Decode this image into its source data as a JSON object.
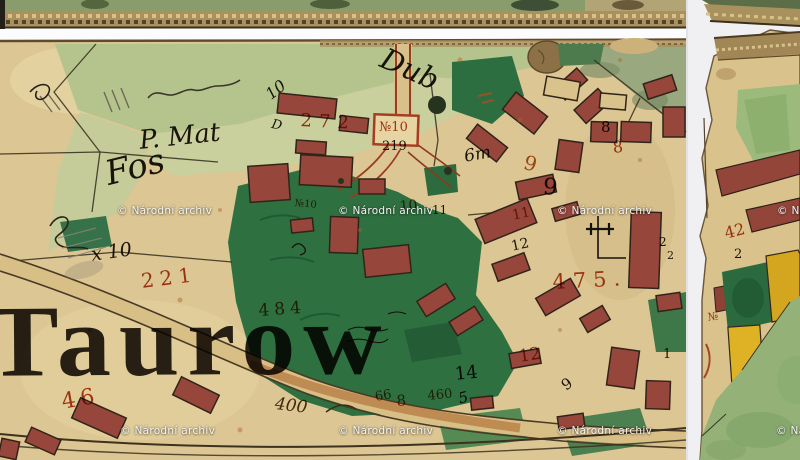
{
  "place_label": {
    "text": "Taurow",
    "color": "#1c150c"
  },
  "watermark": {
    "text": "© Národní archiv",
    "color": "#f4f4f2",
    "positions": [
      {
        "x": 117,
        "y": 205
      },
      {
        "x": 338,
        "y": 205
      },
      {
        "x": 557,
        "y": 205
      },
      {
        "x": 777,
        "y": 205
      },
      {
        "x": 120,
        "y": 425
      },
      {
        "x": 338,
        "y": 425
      },
      {
        "x": 557,
        "y": 425
      },
      {
        "x": 776,
        "y": 425
      }
    ]
  },
  "palette": {
    "paper_tan": "#dcc693",
    "field_green_light": "#b5c48c",
    "field_green_pale": "#c7cf9e",
    "garden_green_dark": "#2e7040",
    "building_maroon": "#96463a",
    "building_yellow": "#d4a51e",
    "red_ink": "#b13f1c",
    "black_ink": "#1f1910",
    "braid_edge": "#a8915c",
    "scan_gap_white": "#fbfbfd",
    "pasture_green": "#94b178"
  },
  "labels": [
    {
      "text": "Dub",
      "x": 388,
      "y": 44,
      "size": 29,
      "rot": 24,
      "script": true,
      "color": "#1f1910"
    },
    {
      "text": "10",
      "x": 263,
      "y": 90,
      "size": 16,
      "rot": -38,
      "script": true,
      "color": "#1f1910"
    },
    {
      "text": "D",
      "x": 273,
      "y": 118,
      "size": 13,
      "rot": 12,
      "script": true,
      "color": "#1f1910"
    },
    {
      "text": "P. Mat",
      "x": 138,
      "y": 128,
      "size": 26,
      "rot": -6,
      "script": true,
      "color": "#1f1910"
    },
    {
      "text": "Fos",
      "x": 102,
      "y": 158,
      "size": 34,
      "rot": -14,
      "script": true,
      "color": "#1f1910"
    },
    {
      "text": "x 10",
      "x": 90,
      "y": 246,
      "size": 19,
      "rot": -8,
      "script": true,
      "color": "#1f1910"
    },
    {
      "text": "219",
      "x": 382,
      "y": 140,
      "size": 13,
      "color": "#1f1910"
    },
    {
      "text": "6m",
      "x": 463,
      "y": 149,
      "size": 17,
      "rot": -10,
      "script": true,
      "color": "#1f1910"
    },
    {
      "text": "8",
      "x": 601,
      "y": 120,
      "size": 15,
      "color": "#1f1910"
    },
    {
      "text": "9",
      "x": 544,
      "y": 176,
      "size": 23,
      "rot": 5,
      "color": "#1f1910"
    },
    {
      "text": "11",
      "x": 432,
      "y": 204,
      "size": 12,
      "color": "#1f1910"
    },
    {
      "text": "12",
      "x": 510,
      "y": 240,
      "size": 14,
      "rot": -12,
      "color": "#1f1910"
    },
    {
      "text": "2",
      "x": 659,
      "y": 236,
      "size": 12,
      "color": "#1f1910"
    },
    {
      "text": "2",
      "x": 667,
      "y": 250,
      "size": 11,
      "color": "#1f1910"
    },
    {
      "text": "2",
      "x": 734,
      "y": 248,
      "size": 13,
      "color": "#1f1910"
    },
    {
      "text": "14",
      "x": 454,
      "y": 366,
      "size": 18,
      "rot": -6,
      "color": "#1f1910"
    },
    {
      "text": "5",
      "x": 457,
      "y": 392,
      "size": 15,
      "rot": -14,
      "script": true,
      "color": "#1f1910"
    },
    {
      "text": "1",
      "x": 663,
      "y": 348,
      "size": 13,
      "color": "#1f1910"
    },
    {
      "text": "9",
      "x": 559,
      "y": 381,
      "size": 15,
      "rot": -35,
      "color": "#1f1910"
    },
    {
      "text": "400",
      "x": 276,
      "y": 396,
      "size": 17,
      "rot": 7,
      "script": true,
      "color": "#4e3416"
    },
    {
      "text": "272",
      "x": 301,
      "y": 112,
      "size": 18,
      "rot": 3,
      "sp": 7,
      "color": "#b13f1c"
    },
    {
      "text": "№10",
      "x": 379,
      "y": 121,
      "size": 13,
      "color": "#b13f1c"
    },
    {
      "text": "9",
      "x": 527,
      "y": 152,
      "size": 20,
      "rot": 16,
      "color": "#b05a1f"
    },
    {
      "text": "8",
      "x": 612,
      "y": 140,
      "size": 16,
      "rot": -6,
      "color": "#b13f1c"
    },
    {
      "text": "10",
      "x": 399,
      "y": 200,
      "size": 14,
      "rot": -5,
      "color": "#b13f1c"
    },
    {
      "text": "11",
      "x": 511,
      "y": 209,
      "size": 14,
      "rot": -12,
      "color": "#b13f1c"
    },
    {
      "text": "№10",
      "x": 295,
      "y": 199,
      "size": 10,
      "rot": 5,
      "color": "#b13f1c"
    },
    {
      "text": "475.",
      "x": 552,
      "y": 272,
      "size": 21,
      "rot": -3,
      "sp": 7,
      "color": "#b3441c"
    },
    {
      "text": "221",
      "x": 140,
      "y": 271,
      "size": 20,
      "rot": -7,
      "sp": 6,
      "color": "#b13f1c"
    },
    {
      "text": "484",
      "x": 258,
      "y": 303,
      "size": 17,
      "rot": -4,
      "sp": 5,
      "color": "#a84420"
    },
    {
      "text": "12",
      "x": 518,
      "y": 349,
      "size": 17,
      "rot": -9,
      "color": "#b13f1c"
    },
    {
      "text": "66",
      "x": 374,
      "y": 391,
      "size": 13,
      "rot": -10,
      "color": "#8d4a1c"
    },
    {
      "text": "8",
      "x": 396,
      "y": 394,
      "size": 15,
      "rot": -5,
      "color": "#b13f1c"
    },
    {
      "text": "460",
      "x": 427,
      "y": 390,
      "size": 13,
      "rot": -6,
      "color": "#8d4a1c"
    },
    {
      "text": "46",
      "x": 60,
      "y": 392,
      "size": 22,
      "rot": -10,
      "sp": 5,
      "color": "#b13f1c"
    },
    {
      "text": "42",
      "x": 723,
      "y": 226,
      "size": 16,
      "rot": -14,
      "color": "#b13f1c"
    },
    {
      "text": "№",
      "x": 707,
      "y": 312,
      "size": 11,
      "rot": -8,
      "color": "#b13f1c"
    }
  ]
}
